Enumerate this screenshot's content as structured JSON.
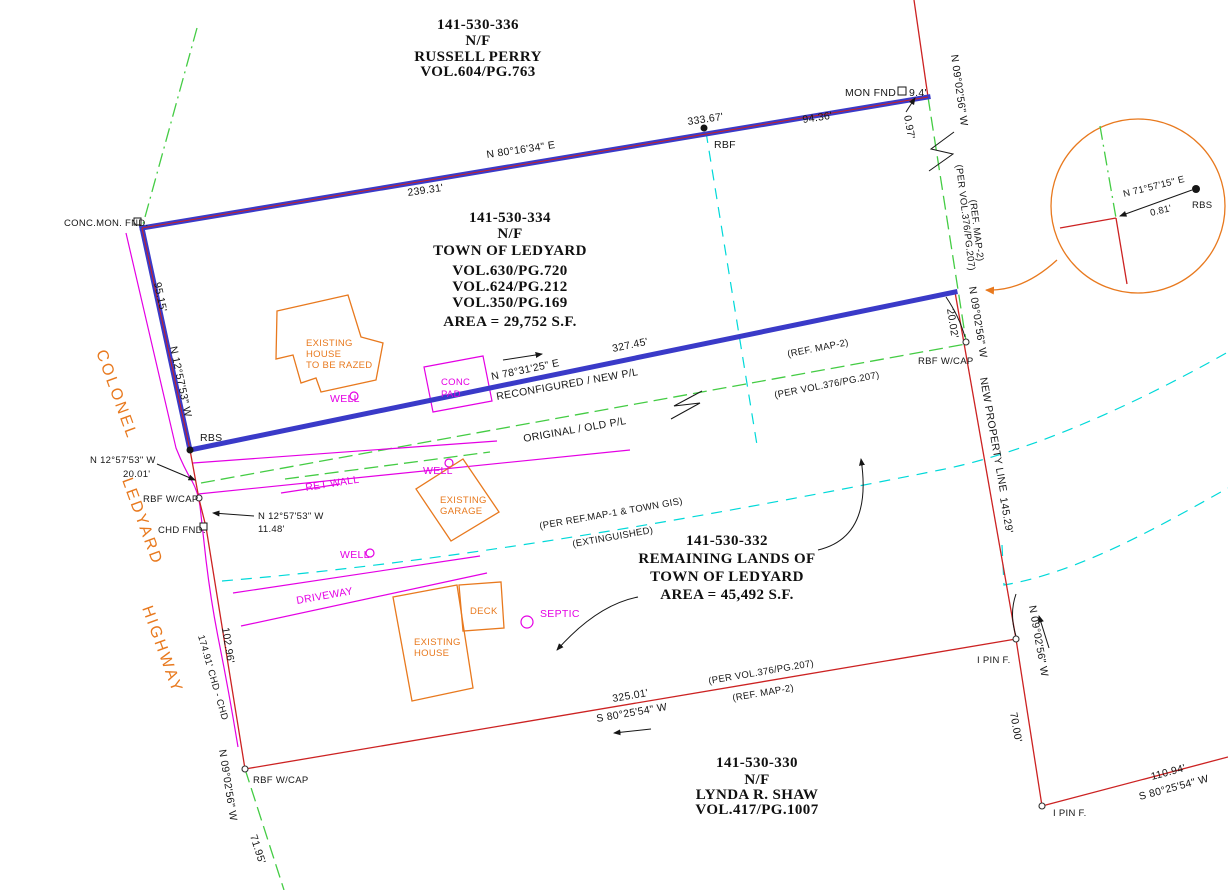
{
  "colors": {
    "new_boundary_blue": "#3a3ac8",
    "boundary_red": "#cc2222",
    "old_line_green": "#44cc44",
    "gis_cyan": "#00d9d9",
    "site_magenta": "#e400e4",
    "detail_orange": "#e8791e"
  },
  "parcels": {
    "perry": {
      "apn": "141-530-336",
      "nf": "N/F",
      "owner": "RUSSELL PERRY",
      "vol": "VOL.604/PG.763"
    },
    "ledyard334": {
      "apn": "141-530-334",
      "nf": "N/F",
      "owner": "TOWN OF LEDYARD",
      "vol1": "VOL.630/PG.720",
      "vol2": "VOL.624/PG.212",
      "vol3": "VOL.350/PG.169",
      "area": "AREA = 29,752 S.F."
    },
    "ledyard332": {
      "apn": "141-530-332",
      "line1": "REMAINING LANDS OF",
      "line2": "TOWN OF LEDYARD",
      "area": "AREA = 45,492 S.F."
    },
    "shaw": {
      "apn": "141-530-330",
      "nf": "N/F",
      "owner": "LYNDA R. SHAW",
      "vol": "VOL.417/PG.1007"
    }
  },
  "road_name": {
    "w1": "COLONEL",
    "w2": "LEDYARD",
    "w3": "HIGHWAY"
  },
  "north_line": {
    "bearing": "N 80°16'34\" E",
    "seg1": "239.31'",
    "seg2": "333.67'",
    "seg3": "94.36'",
    "rbf": "RBF",
    "mon": "MON FND",
    "mon_tie": "9.4'",
    "corner_tie": "0.97'",
    "bearing_ne": "N 09°02'56\" W"
  },
  "west_line": {
    "mon": "CONC.MON. FND.",
    "dist": "95.15'",
    "bearing": "N 12°57'53\" W",
    "rbs": "RBS"
  },
  "new_pl": {
    "bearing": "N 78°31'25\" E",
    "dist": "327.45'",
    "label": "RECONFIGURED / NEW P/L"
  },
  "old_pl": {
    "label": "ORIGINAL / OLD P/L",
    "ref": "(REF. MAP-2)",
    "per": "(PER VOL.376/PG.207)"
  },
  "east_line": {
    "per": "(PER VOL.376/PG.207)",
    "ref": "(REF. MAP-2)",
    "bearing": "N 09°02'56\" W",
    "tie": "20.02'",
    "rbf_cap": "RBF W/CAP",
    "new_label": "NEW PROPERTY LINE",
    "dist": "145.29'",
    "pin1": "I PIN F.",
    "bearing2": "N 09°02'56\" W",
    "dist2": "70.00'",
    "pin2": "I PIN F.",
    "dist3": "110.94'",
    "bearing3": "S 80°25'54\" W"
  },
  "south_line": {
    "dist": "325.01'",
    "bearing": "S 80°25'54\" W",
    "per": "(PER VOL.376/PG.207)",
    "ref": "(REF. MAP-2)"
  },
  "road_line": {
    "tie1_bearing": "N 12°57'53\" W",
    "tie1_dist": "20.01'",
    "rbf_cap1": "RBF W/CAP",
    "tie2_bearing": "N 12°57'53\" W",
    "tie2_dist": "11.48'",
    "chd_fnd": "CHD FND.",
    "dist": "102.96'",
    "chord": "174.91' CHD - CHD",
    "bearing": "N 09°02'56\" W",
    "rbf_cap2": "RBF W/CAP",
    "dist2": "71.95'"
  },
  "gis_line": {
    "per": "(PER REF.MAP-1 & TOWN GIS)",
    "status": "(EXTINGUISHED)"
  },
  "site": {
    "house1_l1": "EXISTING",
    "house1_l2": "HOUSE",
    "house1_l3": "TO BE RAZED",
    "pad_l1": "CONC",
    "pad_l2": "PAD",
    "well": "WELL",
    "ret_wall": "RET WALL",
    "garage_l1": "EXISTING",
    "garage_l2": "GARAGE",
    "driveway": "DRIVEWAY",
    "house2_l1": "EXISTING",
    "house2_l2": "HOUSE",
    "deck": "DECK",
    "septic": "SEPTIC"
  },
  "detail": {
    "bearing": "N 71°57'15\" E",
    "dist": "0.81'",
    "rbs": "RBS"
  }
}
